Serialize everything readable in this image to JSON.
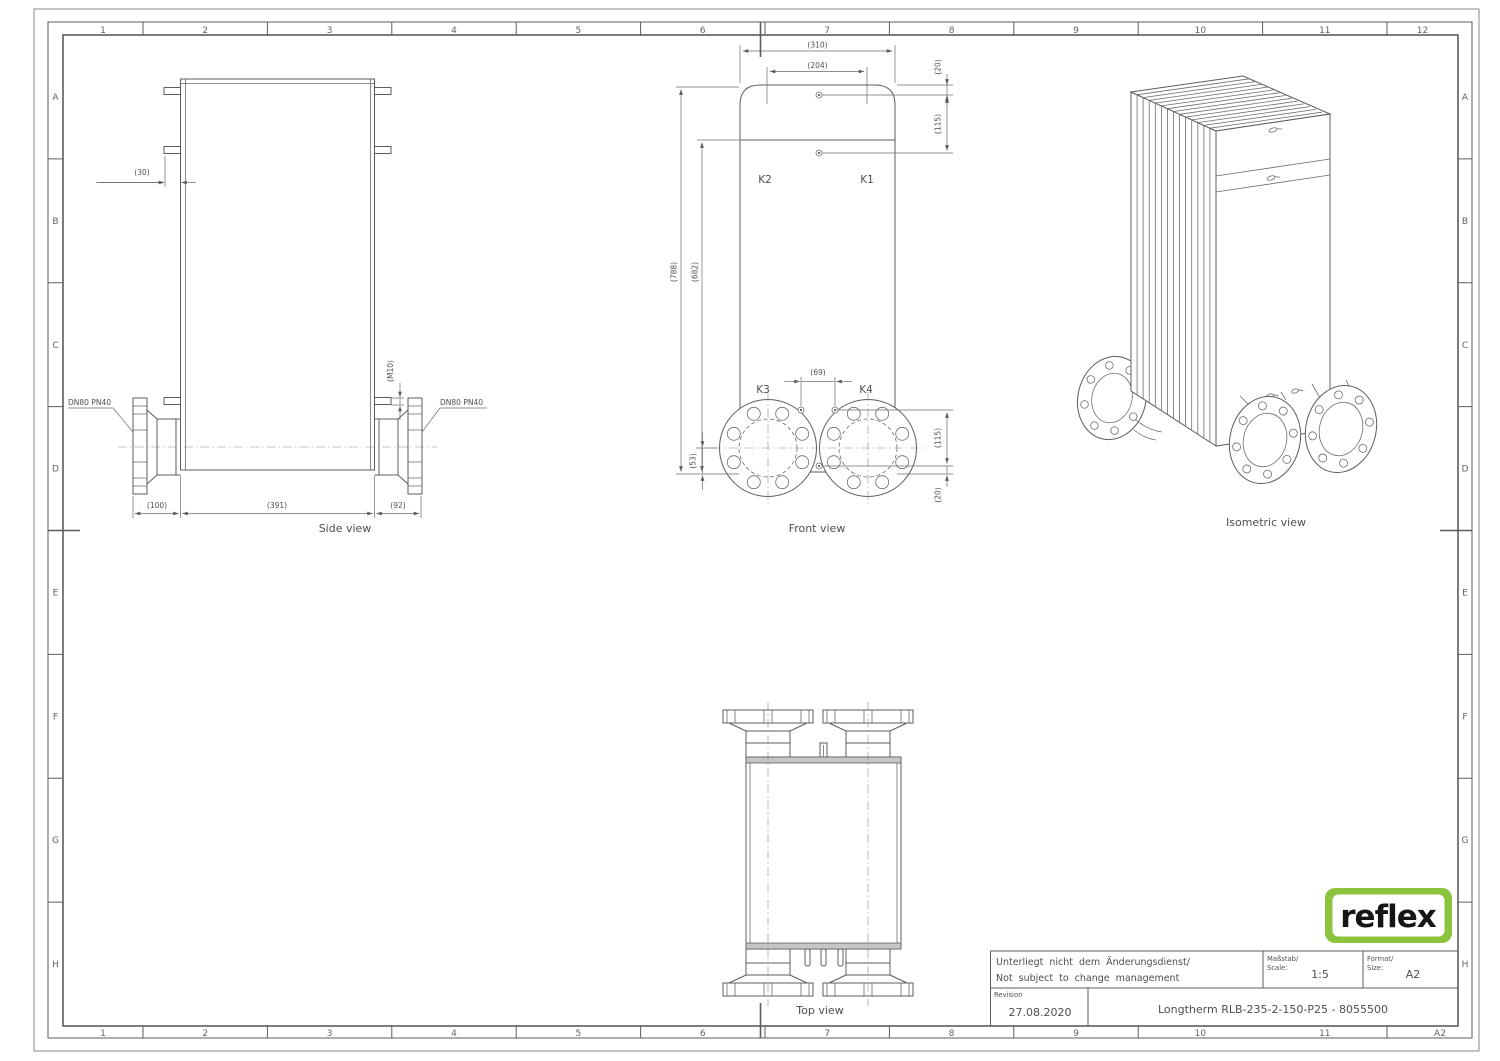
{
  "sheet": {
    "grid_cols_top": [
      "1",
      "2",
      "3",
      "4",
      "5",
      "6",
      "7",
      "8",
      "9",
      "10",
      "11",
      "12"
    ],
    "grid_cols_bottom": [
      "1",
      "2",
      "3",
      "4",
      "5",
      "6",
      "7",
      "8",
      "9",
      "10",
      "11",
      "A2"
    ],
    "grid_rows": [
      "A",
      "B",
      "C",
      "D",
      "E",
      "F",
      "G",
      "H"
    ]
  },
  "views": {
    "side": "Side view",
    "front": "Front view",
    "iso": "Isometric view",
    "top": "Top view"
  },
  "ports": {
    "k1": "K1",
    "k2": "K2",
    "k3": "K3",
    "k4": "K4"
  },
  "notes": {
    "flange_left": "DN80 PN40",
    "flange_right": "DN80 PN40"
  },
  "dims": {
    "d30": "(30)",
    "m10": "(M10)",
    "d100": "(100)",
    "d391": "(391)",
    "d92": "(92)",
    "d310": "(310)",
    "d204": "(204)",
    "d20_top": "(20)",
    "d115_top": "(115)",
    "d788": "(788)",
    "d682": "(682)",
    "d69": "(69)",
    "d53": "(53)",
    "d115_bot": "(115)",
    "d20_bot": "(20)"
  },
  "title_block": {
    "note_de": "Unterliegt nicht dem Änderungsdienst/",
    "note_en": "Not subject to change management",
    "scale_label_de": "Maßstab/",
    "scale_label_en": "Scale:",
    "scale_value": "1:5",
    "format_label_de": "Format/",
    "format_label_en": "Size:",
    "format_value": "A2",
    "revision_label": "Revision",
    "revision_date": "27.08.2020",
    "drawing_title": "Longtherm RLB-235-2-150-P25 - 8055500"
  },
  "logo": {
    "text": "reflex",
    "green": "#8cc43d"
  }
}
